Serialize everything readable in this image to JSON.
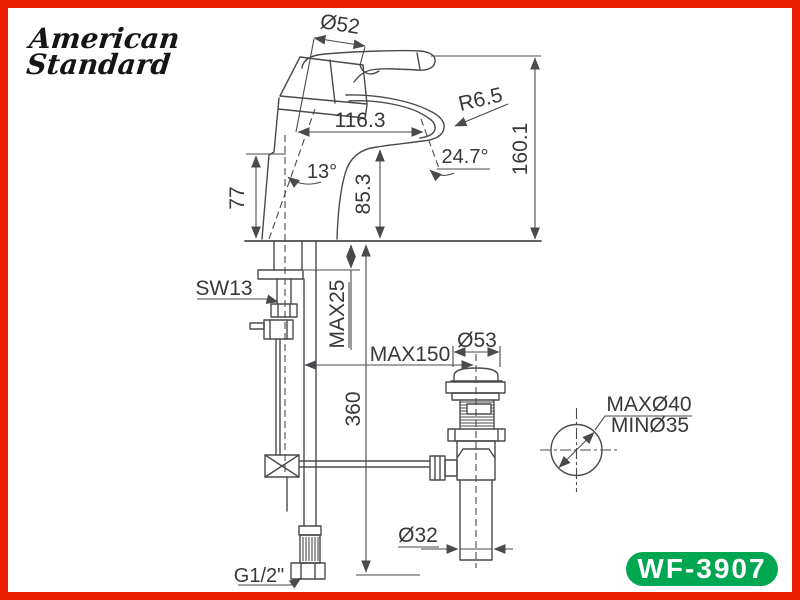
{
  "brand": {
    "line1": "American",
    "line2": "Standard"
  },
  "model_badge": "WF-3907",
  "colors": {
    "frame": "#ea1c02",
    "badge": "#00a650",
    "line": "#4a4a4e",
    "text": "#38383c"
  },
  "dimensions": {
    "spout_top_diameter": "Ø52",
    "spout_tip_radius": "R6.5",
    "spout_reach": "116.3",
    "outlet_angle": "24.7°",
    "body_tilt_angle": "13°",
    "outlet_height": "85.3",
    "base_front_height": "77",
    "overall_height": "160.1",
    "hose_wrench": "SW13",
    "max_deck_thickness": "MAX25",
    "max_drain_offset": "MAX150",
    "drain_flange_diameter": "Ø53",
    "hose_length": "360",
    "tailpiece_diameter": "Ø32",
    "hole_diameter_max": "MAXØ40",
    "hole_diameter_min": "MINØ35",
    "supply_connection": "G1/2\""
  }
}
